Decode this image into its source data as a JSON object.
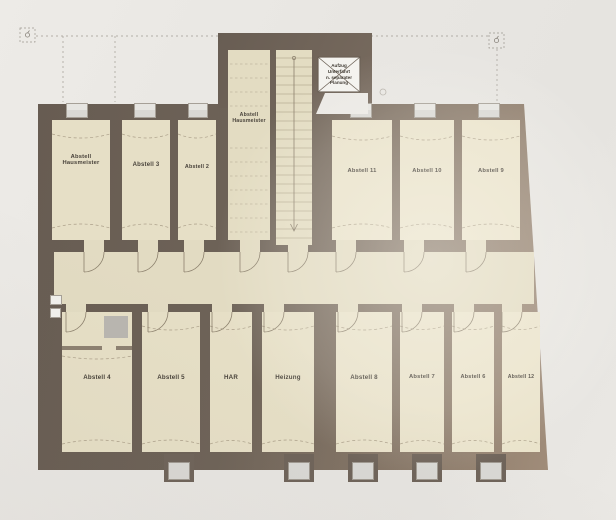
{
  "plan": {
    "elevator_note": "Aufzug\nUnterfahrt\nn. separater\nPlanung",
    "rooms": {
      "abstell_hausmeister_links": {
        "label": "Abstell\nHausmeister"
      },
      "abstell_3": {
        "label": "Abstell 3"
      },
      "abstell_2": {
        "label": "Abstell 2"
      },
      "abstell_hausmeister_mitte": {
        "label": "Abstell\nHausmeister"
      },
      "abstell_11": {
        "label": "Abstell 11"
      },
      "abstell_10": {
        "label": "Abstell 10"
      },
      "abstell_9": {
        "label": "Abstell 9"
      },
      "abstell_4": {
        "label": "Abstell 4"
      },
      "abstell_5": {
        "label": "Abstell 5"
      },
      "har": {
        "label": "HAR"
      },
      "heizung": {
        "label": "Heizung"
      },
      "abstell_8": {
        "label": "Abstell 8"
      },
      "abstell_7": {
        "label": "Abstell 7"
      },
      "abstell_6": {
        "label": "Abstell 6"
      },
      "abstell_12": {
        "label": "Abstell 12"
      }
    },
    "colors": {
      "wall": "#6f6459",
      "room_fill": "#e6dfc6",
      "corridor_fill": "#e2dbc2",
      "paper": "#e9e7e3",
      "window": "#d9d8d4",
      "label_text": "#48423a"
    }
  }
}
